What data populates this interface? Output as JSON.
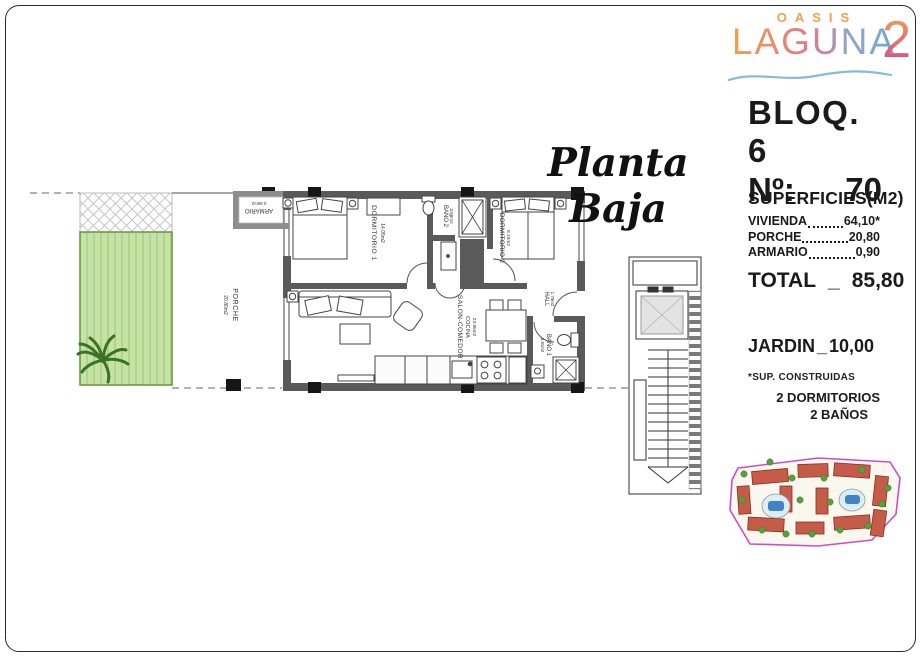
{
  "logo": {
    "line1": "OASIS",
    "line2": "LAGUNA",
    "badge": "2"
  },
  "header": {
    "block": "BLOQ. 6",
    "unit_label": "Nº:",
    "unit_number": "70",
    "plan_title": "Planta Baja"
  },
  "surfaces": {
    "title": "SUPERFICIES(M2)",
    "rows": [
      {
        "label": "VIVIENDA",
        "value": "64,10*"
      },
      {
        "label": "PORCHE",
        "value": "20,80"
      },
      {
        "label": "ARMARIO",
        "value": "0,90"
      }
    ],
    "total": {
      "label": "TOTAL",
      "sep": "_",
      "value": "85,80"
    }
  },
  "garden_line": {
    "label": "JARDIN",
    "sep": "_",
    "value": "10,00"
  },
  "footnote": "*SUP. CONSTRUIDAS",
  "features": [
    "2 DORMITORIOS",
    "2 BAÑOS"
  ],
  "floor_plan": {
    "rooms": {
      "dormitorio1": {
        "name": "DORMITORIO 1",
        "area": "14.05m2"
      },
      "bano2": {
        "name": "BAÑO 2",
        "area": "3.86m2"
      },
      "dormitorio2": {
        "name": "DORMITORIO 2",
        "area": "8.15m2"
      },
      "salon": {
        "name": "SALON-COMEDOR",
        "name2": "COCINA",
        "area": "23.95m2"
      },
      "hall": {
        "name": "HALL",
        "area": "1.79m2"
      },
      "bano1": {
        "name": "BAÑO 1",
        "area": "3.91m2"
      },
      "porche": {
        "name": "PORCHE",
        "area": "20.80m2"
      },
      "armario": {
        "name": "ARMARIO",
        "area": "0.90m2"
      }
    }
  },
  "colors": {
    "logo_orange": "#eda24f",
    "logo_pink": "#e2798b",
    "logo_blue": "#6fa9d6",
    "wave_blue": "#85bdd9",
    "garden_green": "#c5e3a6",
    "wall_gray": "#5a5a5a",
    "site_boundary_magenta": "#c94fc9"
  }
}
